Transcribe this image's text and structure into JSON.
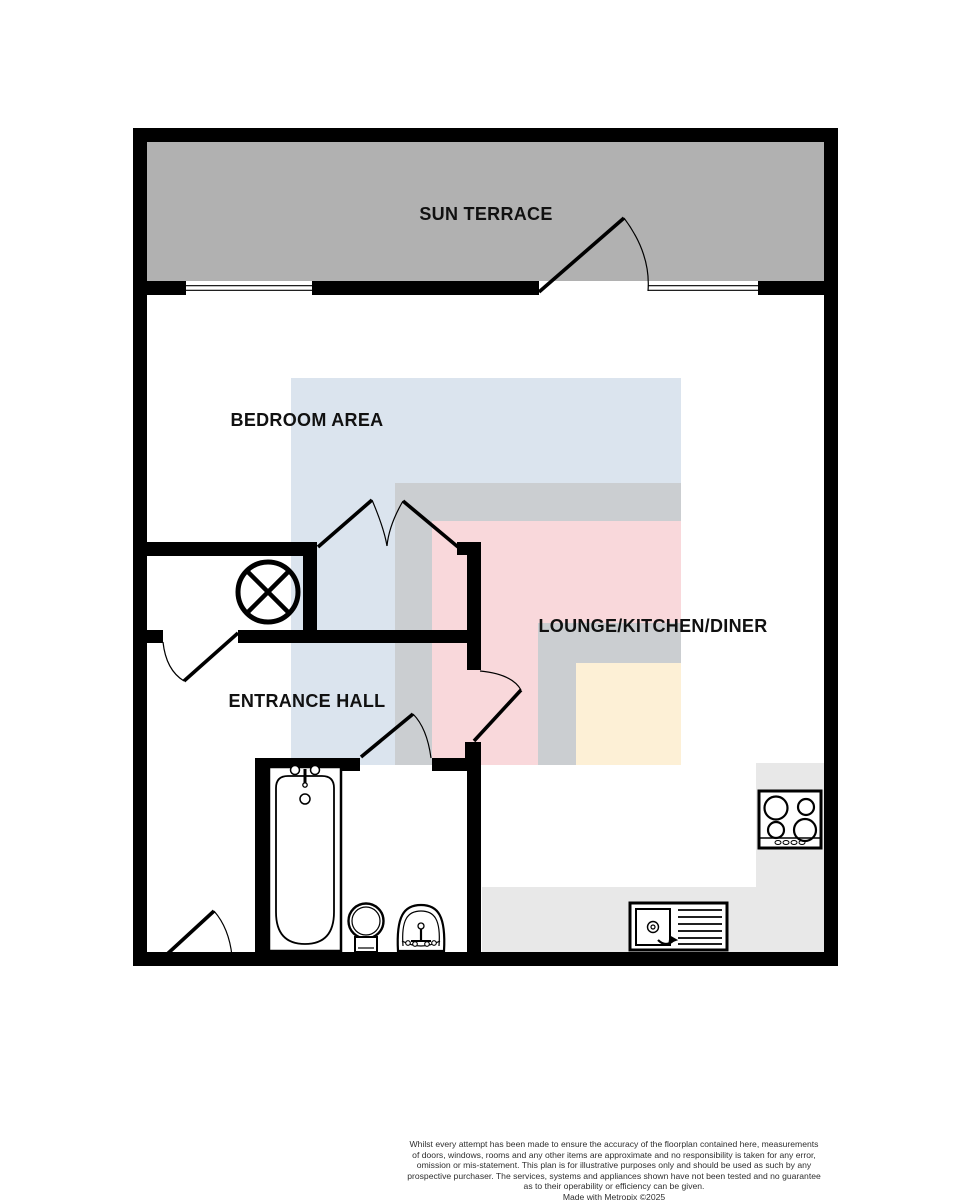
{
  "floorplan": {
    "rooms": [
      {
        "id": "sun-terrace",
        "label": "SUN TERRACE"
      },
      {
        "id": "bedroom-area",
        "label": "BEDROOM AREA"
      },
      {
        "id": "lounge-kitchen-diner",
        "label": "LOUNGE/KITCHEN/DINER"
      },
      {
        "id": "entrance-hall",
        "label": "ENTRANCE HALL"
      }
    ],
    "fixtures": [
      "bath",
      "toilet",
      "basin",
      "hob",
      "kitchen-sink-drainer",
      "appliance-circle-cross"
    ],
    "colors": {
      "wall": "#000000",
      "floor": "#ffffff",
      "terrace_floor": "#b1b1b1",
      "zone_blue": "#dbe4ee",
      "zone_gray": "#cbced1",
      "zone_pink": "#f9d8db",
      "zone_cream": "#fdf0d6",
      "worktop": "#e8e8e8",
      "label_text": "#111111",
      "disclaimer_text": "#2f2f2f"
    }
  },
  "footer": {
    "disclaimer_lines": [
      "Whilst every attempt has been made to ensure the accuracy of the floorplan contained here, measurements",
      "of doors, windows, rooms and any other items are approximate and no responsibility is taken for any error,",
      "omission or mis-statement. This plan is for illustrative purposes only and should be used as such by any",
      "prospective purchaser. The services, systems and appliances shown have not been tested and no guarantee",
      "as to their operability or efficiency can be given."
    ],
    "credit": "Made with Metropix ©2025"
  }
}
